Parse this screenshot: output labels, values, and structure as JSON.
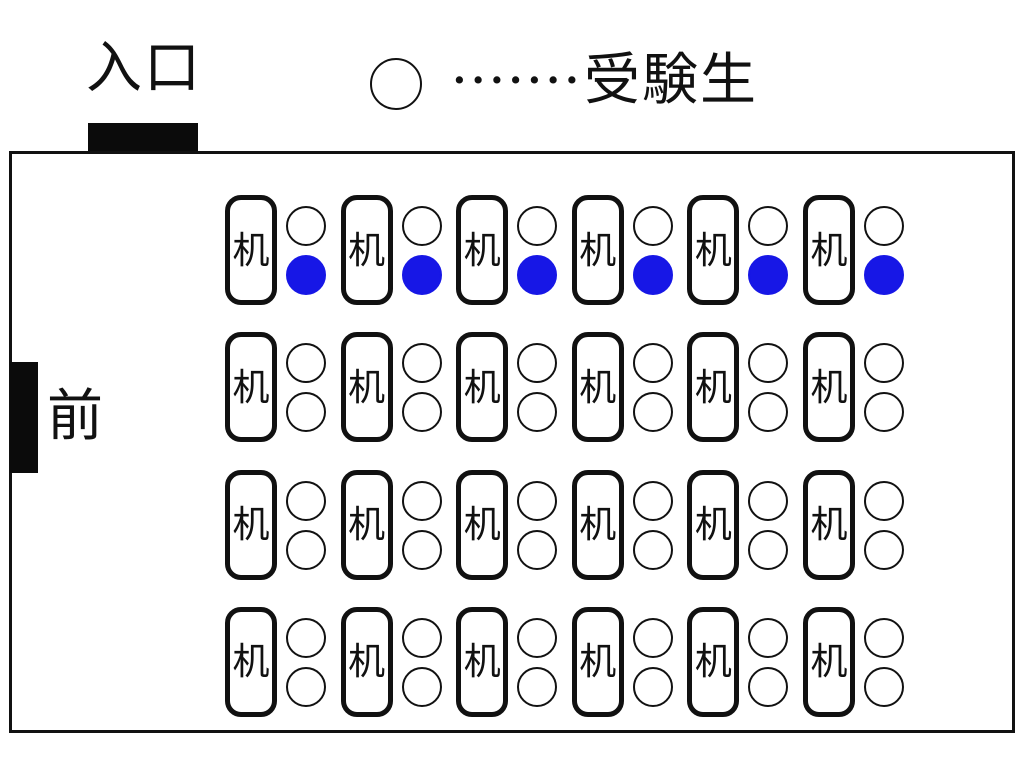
{
  "diagram": {
    "entrance_label": "入口",
    "front_label": "前",
    "legend": {
      "symbol": "empty-circle",
      "dots": "•••••••",
      "label": "受験生"
    },
    "colors": {
      "occupied_seat": "#1717e6",
      "line": "#111111"
    },
    "room": {
      "rows": [
        {
          "desks": [
            {
              "label": "机",
              "top_seat": "empty",
              "bottom_seat": "occupied"
            },
            {
              "label": "机",
              "top_seat": "empty",
              "bottom_seat": "occupied"
            },
            {
              "label": "机",
              "top_seat": "empty",
              "bottom_seat": "occupied"
            },
            {
              "label": "机",
              "top_seat": "empty",
              "bottom_seat": "occupied"
            },
            {
              "label": "机",
              "top_seat": "empty",
              "bottom_seat": "occupied"
            },
            {
              "label": "机",
              "top_seat": "empty",
              "bottom_seat": "occupied"
            }
          ]
        },
        {
          "desks": [
            {
              "label": "机",
              "top_seat": "empty",
              "bottom_seat": "empty"
            },
            {
              "label": "机",
              "top_seat": "empty",
              "bottom_seat": "empty"
            },
            {
              "label": "机",
              "top_seat": "empty",
              "bottom_seat": "empty"
            },
            {
              "label": "机",
              "top_seat": "empty",
              "bottom_seat": "empty"
            },
            {
              "label": "机",
              "top_seat": "empty",
              "bottom_seat": "empty"
            },
            {
              "label": "机",
              "top_seat": "empty",
              "bottom_seat": "empty"
            }
          ]
        },
        {
          "desks": [
            {
              "label": "机",
              "top_seat": "empty",
              "bottom_seat": "empty"
            },
            {
              "label": "机",
              "top_seat": "empty",
              "bottom_seat": "empty"
            },
            {
              "label": "机",
              "top_seat": "empty",
              "bottom_seat": "empty"
            },
            {
              "label": "机",
              "top_seat": "empty",
              "bottom_seat": "empty"
            },
            {
              "label": "机",
              "top_seat": "empty",
              "bottom_seat": "empty"
            },
            {
              "label": "机",
              "top_seat": "empty",
              "bottom_seat": "empty"
            }
          ]
        },
        {
          "desks": [
            {
              "label": "机",
              "top_seat": "empty",
              "bottom_seat": "empty"
            },
            {
              "label": "机",
              "top_seat": "empty",
              "bottom_seat": "empty"
            },
            {
              "label": "机",
              "top_seat": "empty",
              "bottom_seat": "empty"
            },
            {
              "label": "机",
              "top_seat": "empty",
              "bottom_seat": "empty"
            },
            {
              "label": "机",
              "top_seat": "empty",
              "bottom_seat": "empty"
            },
            {
              "label": "机",
              "top_seat": "empty",
              "bottom_seat": "empty"
            }
          ]
        }
      ]
    }
  }
}
